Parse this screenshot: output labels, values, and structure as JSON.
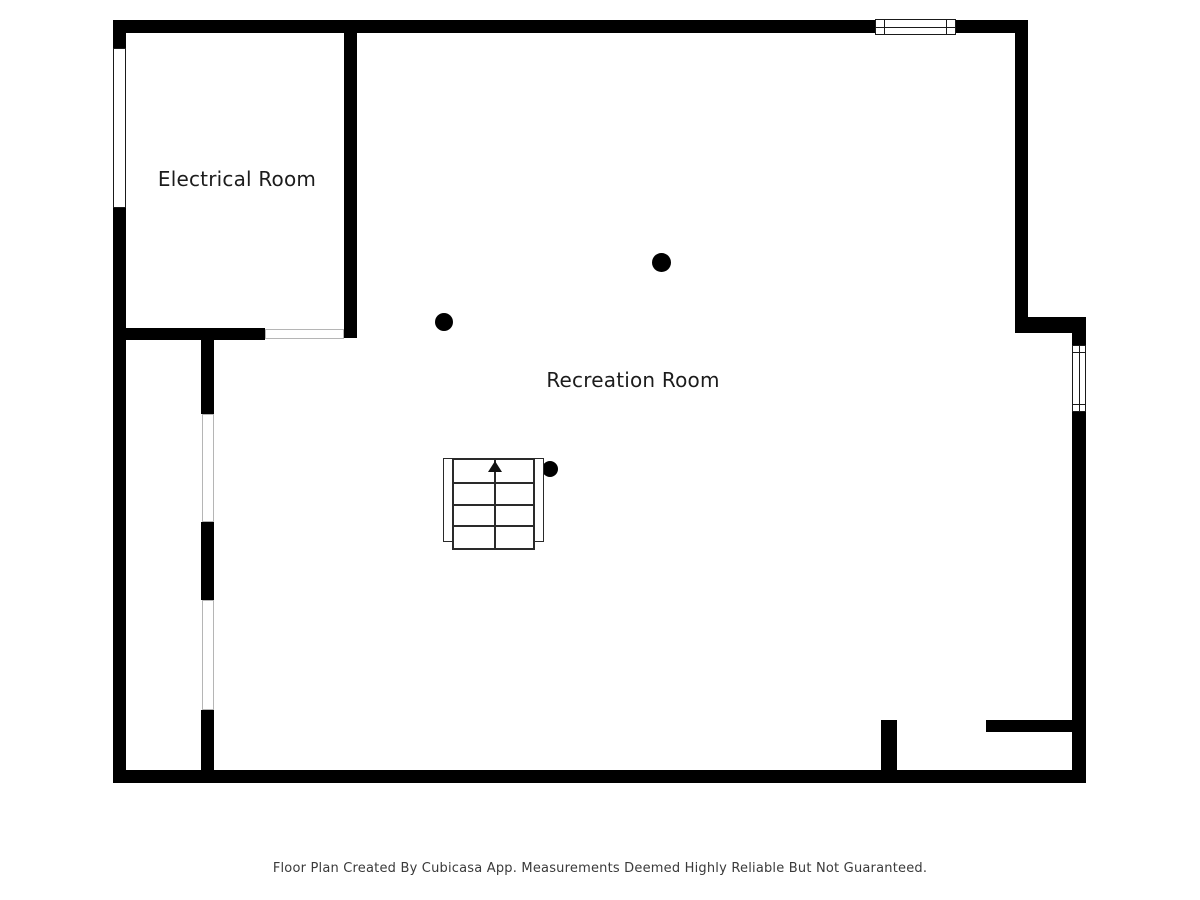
{
  "floorplan": {
    "rooms": [
      {
        "name": "Electrical Room"
      },
      {
        "name": "Recreation Room"
      }
    ],
    "footer": "Floor Plan Created By Cubicasa App. Measurements Deemed Highly Reliable But Not Guaranteed.",
    "colors": {
      "wall": "#000000",
      "label": "#1c1c1c",
      "footer": "#3a3a3a",
      "background": "#ffffff"
    },
    "features": {
      "staircase": {
        "direction": "up",
        "visible_steps": 4
      },
      "column_count": 3,
      "window_count": 3,
      "door_opening_count": 3
    }
  }
}
